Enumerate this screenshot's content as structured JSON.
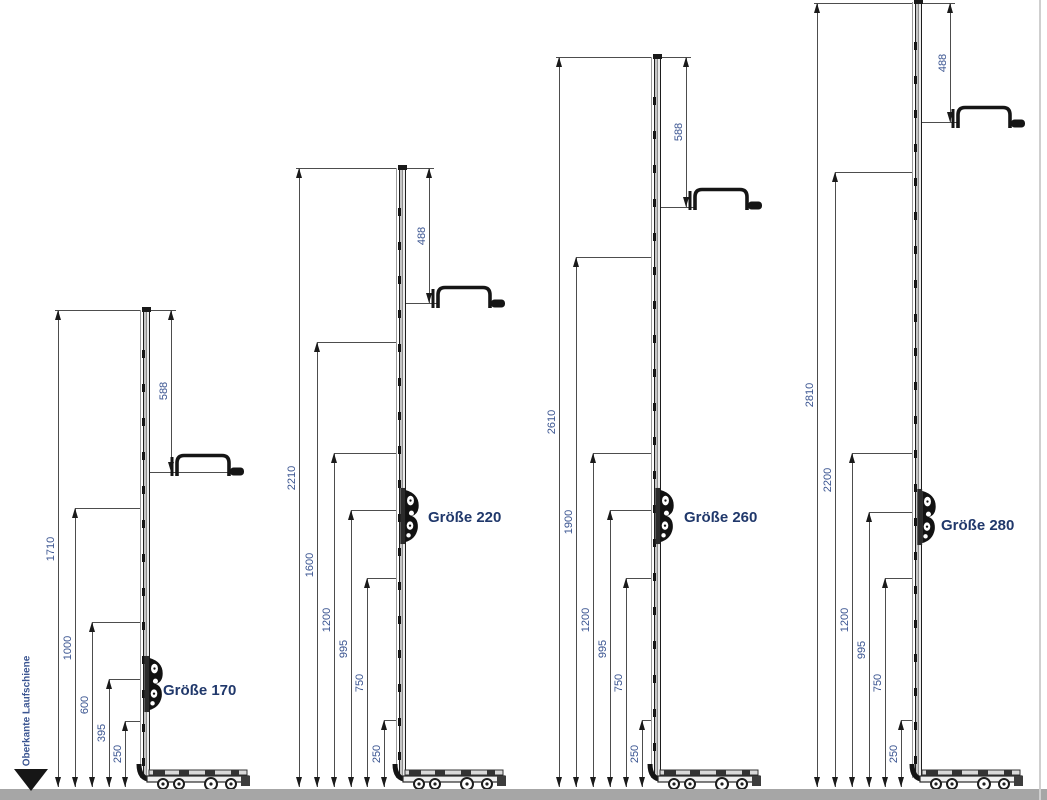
{
  "page": {
    "baseline_label": "Oberkante Laufschiene",
    "colors": {
      "dimension_text": "#3b5591",
      "size_label_text": "#20386b",
      "ground_bar": "#a6a6a6",
      "line": "#4d4d4d"
    }
  },
  "assemblies": [
    {
      "label": "Größe 170",
      "top_dim": "588",
      "left_dims": [
        "1710",
        "1000",
        "600",
        "395",
        "250"
      ]
    },
    {
      "label": "Größe 220",
      "top_dim": "488",
      "left_dims": [
        "2210",
        "1600",
        "1200",
        "995",
        "750",
        "250"
      ]
    },
    {
      "label": "Größe 260",
      "top_dim": "588",
      "left_dims": [
        "2610",
        "1900",
        "1200",
        "995",
        "750",
        "250"
      ]
    },
    {
      "label": "Größe 280",
      "top_dim": "488",
      "left_dims": [
        "2810",
        "2200",
        "1200",
        "995",
        "750",
        "250"
      ]
    }
  ]
}
